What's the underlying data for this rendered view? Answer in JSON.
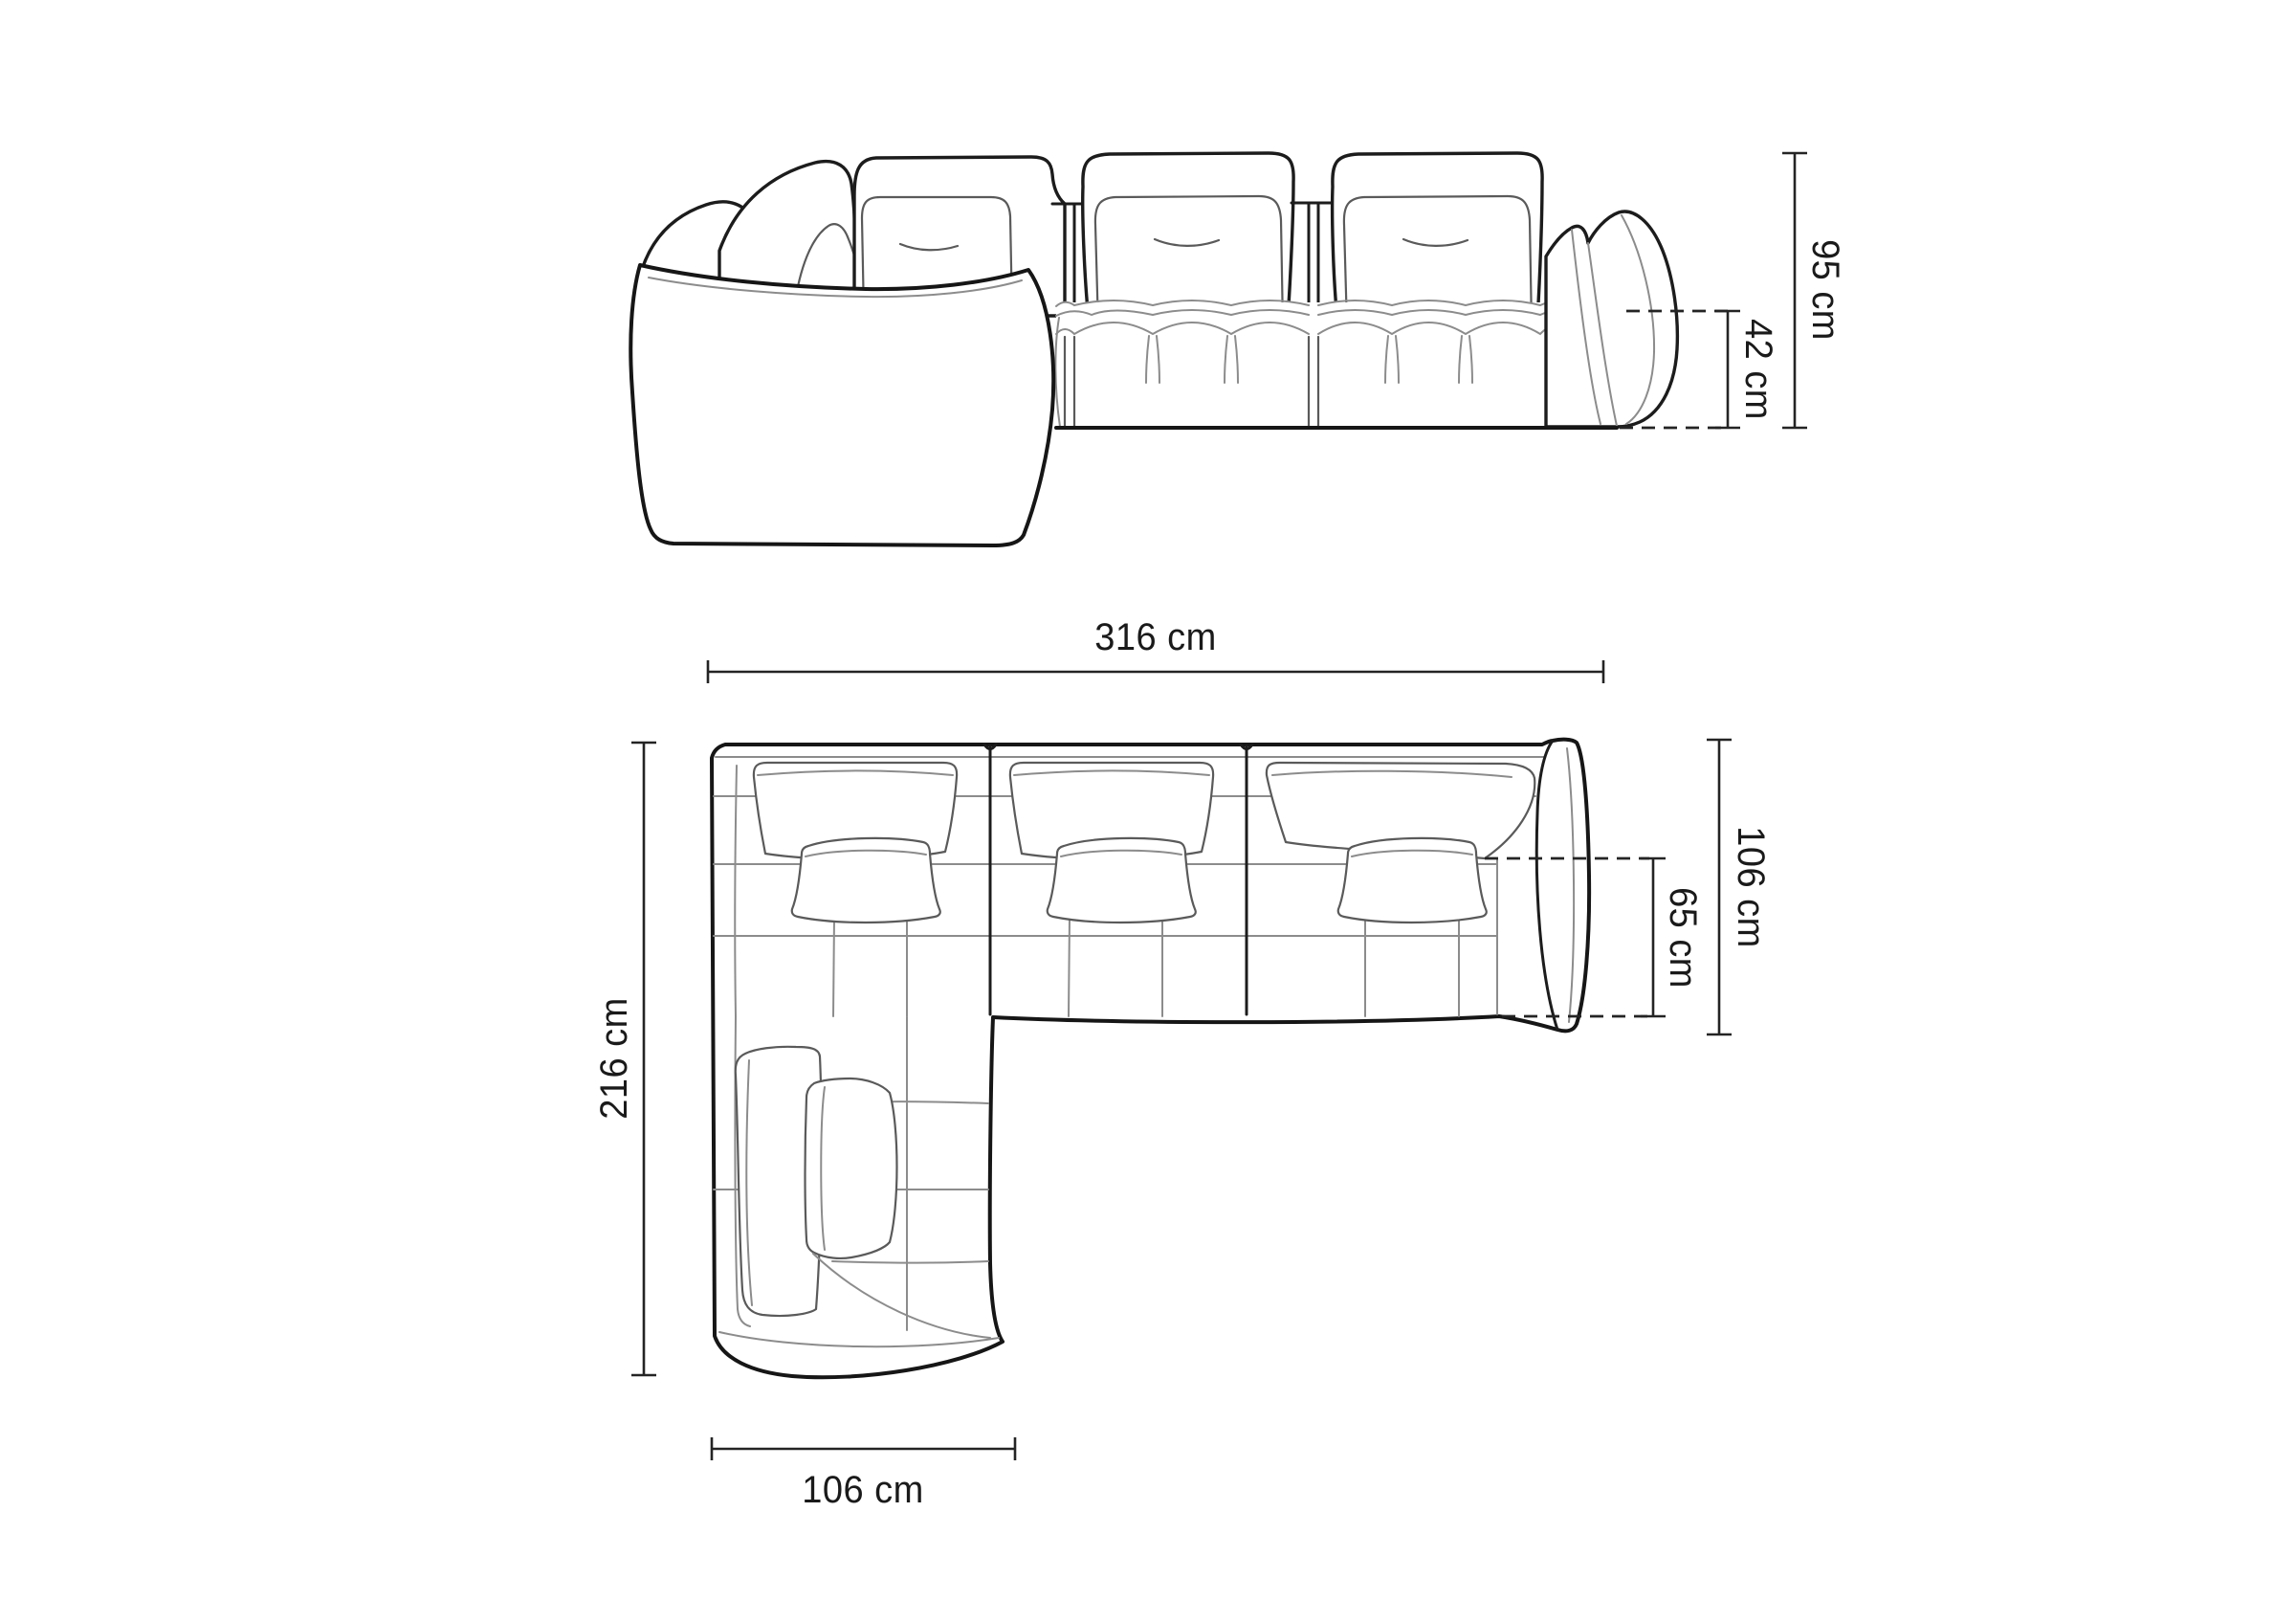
{
  "diagram": {
    "title": "sofa-technical-drawing",
    "views": {
      "front": {
        "name": "front-elevation",
        "dimensions": {
          "total_height": "95 cm",
          "seat_height": "42 cm"
        }
      },
      "top": {
        "name": "top-plan",
        "dimensions": {
          "total_width": "316 cm",
          "total_depth": "216 cm",
          "side_depth": "106 cm",
          "seat_depth": "65 cm",
          "chaise_width": "106 cm"
        }
      }
    },
    "colors": {
      "background": "#ffffff",
      "outline": "#1c1c1c",
      "detail": "#8c8c8c",
      "dimension": "#242424"
    }
  }
}
